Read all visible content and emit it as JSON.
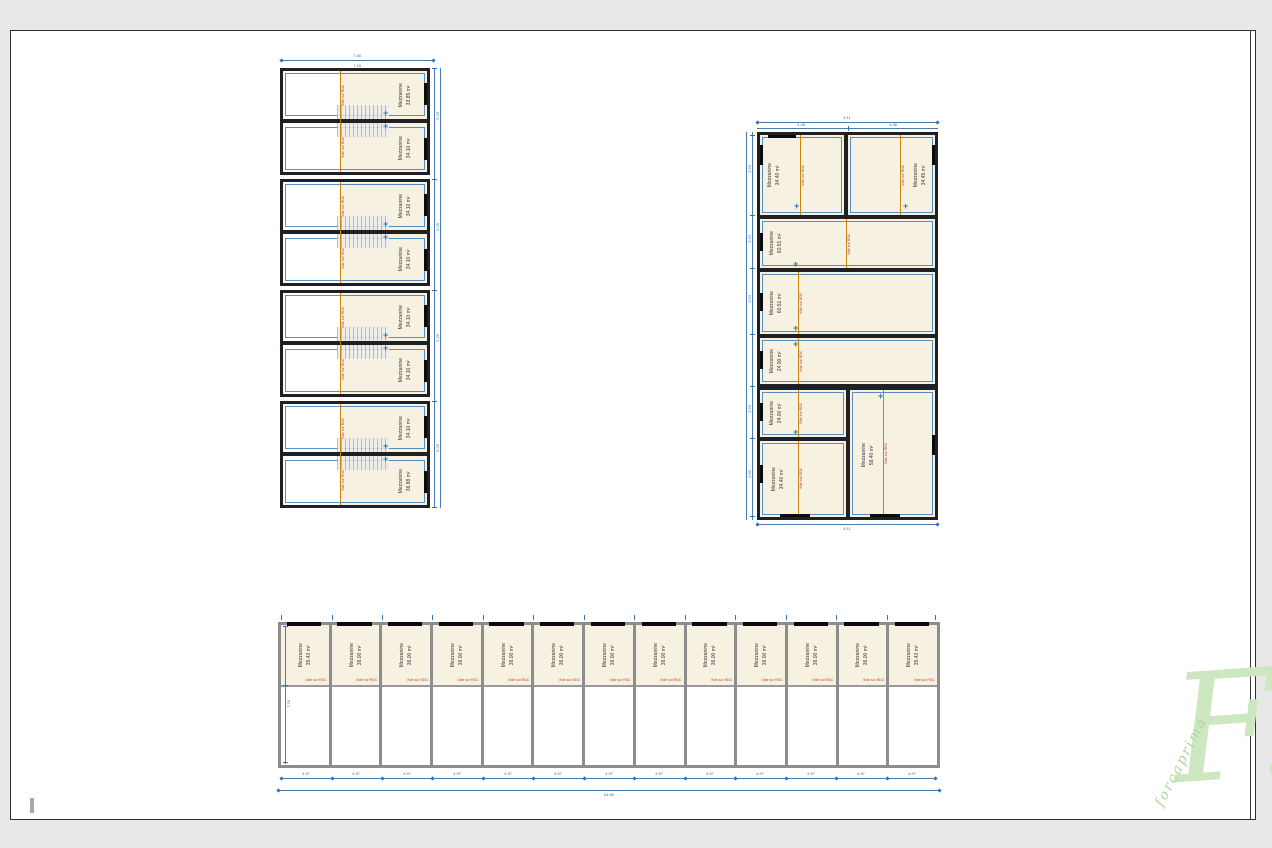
{
  "labels": {
    "room": "Mezzanine",
    "void": "Vide sur RDC"
  },
  "icons": {
    "level_marker": "+"
  },
  "colors": {
    "wall_dark": "#1f1f24",
    "wall_gray": "#8d8d8d",
    "beige": "#f6f1e1",
    "void_line_orange": "#c8860a",
    "void_text_red": "#b5443a",
    "dimension_blue": "#2e75b6",
    "watermark_green": "#cde7c1"
  },
  "plan_left": {
    "modules": [
      {
        "rooms": [
          {
            "area": "33.85 m²"
          },
          {
            "area": "34.10 m²"
          }
        ]
      },
      {
        "rooms": [
          {
            "area": "34.10 m²"
          },
          {
            "area": "34.10 m²"
          }
        ]
      },
      {
        "rooms": [
          {
            "area": "34.10 m²"
          },
          {
            "area": "34.10 m²"
          }
        ]
      },
      {
        "rooms": [
          {
            "area": "34.10 m²"
          },
          {
            "area": "36.88 m²"
          }
        ]
      }
    ],
    "dims": {
      "top_total": "7.58",
      "top_inner": "7.18",
      "side": "5.29"
    }
  },
  "plan_right": {
    "row1": [
      {
        "area": "34.40 m²"
      },
      {
        "area": "34.45 m²"
      }
    ],
    "wide": [
      {
        "area": "60.51 m²"
      },
      {
        "area": "60.51 m²"
      },
      {
        "area": "24.00 m²"
      }
    ],
    "bottom_left": [
      {
        "area": "24.00 m²"
      },
      {
        "area": "34.40 m²"
      }
    ],
    "bottom_right": {
      "area": "58.40 m²"
    },
    "dims": {
      "top_total": "9.11",
      "seg": "4.48",
      "side": "3.93",
      "bottom": "9.11"
    }
  },
  "plan_bottom": {
    "units": [
      {
        "area": "35.43 m²"
      },
      {
        "area": "36.00 m²"
      },
      {
        "area": "36.00 m²"
      },
      {
        "area": "36.00 m²"
      },
      {
        "area": "36.00 m²"
      },
      {
        "area": "36.00 m²"
      },
      {
        "area": "36.00 m²"
      },
      {
        "area": "36.00 m²"
      },
      {
        "area": "36.00 m²"
      },
      {
        "area": "36.00 m²"
      },
      {
        "area": "36.00 m²"
      },
      {
        "area": "36.00 m²"
      },
      {
        "area": "35.43 m²"
      }
    ],
    "dims": {
      "segment": "4.97",
      "total": "64.66",
      "height": "7.20"
    }
  },
  "watermark": {
    "letter": "F.",
    "text": "forcaprima"
  }
}
